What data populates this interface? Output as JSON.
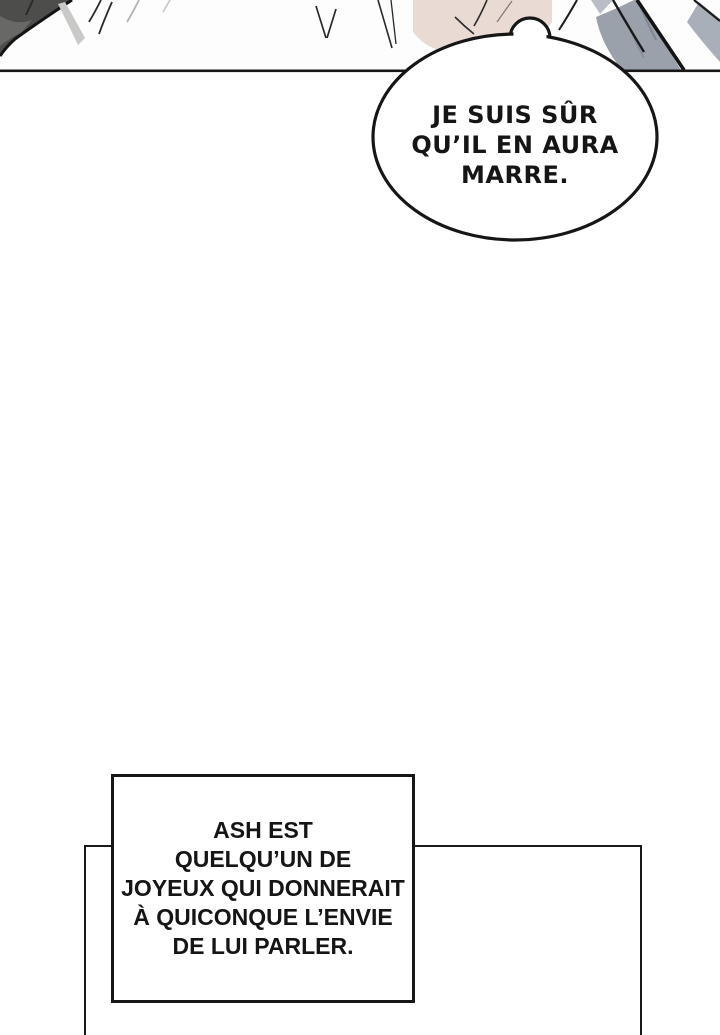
{
  "comic": {
    "speech_bubble": {
      "lines": [
        "JE SUIS SÛR",
        "QU’IL EN AURA",
        "MARRE."
      ]
    },
    "narration_box": {
      "lines": [
        "ASH EST",
        "QUELQU’UN DE",
        "JOYEUX QUI DONNERAIT",
        "À QUICONQUE L’ENVIE",
        "DE LUI PARLER."
      ]
    },
    "colors": {
      "outline": "#1a1a1a",
      "panel_background": "#fdfdfd",
      "hair_pink": "#e9dad4",
      "clothing_gray": "#9aa1ab",
      "clothing_gray_light": "#a9afb8",
      "collar_gray_soft": "#b9bec6",
      "dark_garment": "#4d4d4b",
      "fold_gray": "#c9c9c7",
      "bubble_fill": "#ffffff",
      "box_fill": "#ffffff",
      "text_color": "#151515"
    }
  }
}
